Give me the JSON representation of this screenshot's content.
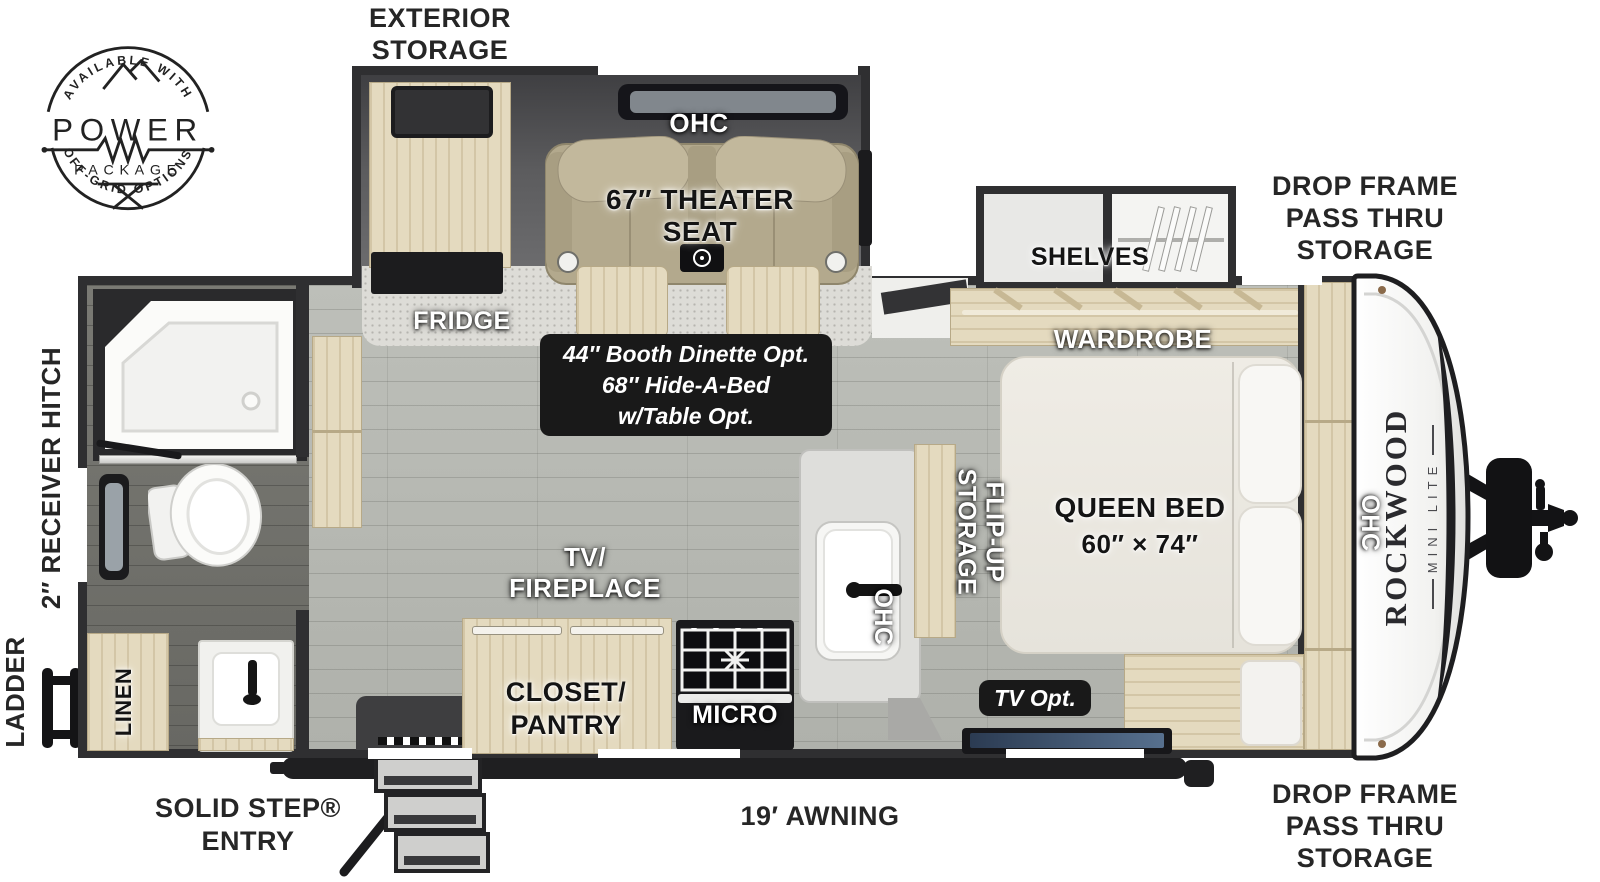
{
  "logo": {
    "arc_top": "AVAILABLE WITH",
    "word": "POWER",
    "word_sub": "PACKAGE",
    "arc_bottom": "OFF-GRID OPTIONS"
  },
  "labels": {
    "exterior_storage": [
      "EXTERIOR",
      "STORAGE"
    ],
    "drop_frame_top": [
      "DROP FRAME",
      "PASS THRU",
      "STORAGE"
    ],
    "drop_frame_bottom": [
      "DROP FRAME",
      "PASS THRU",
      "STORAGE"
    ],
    "receiver_hitch": "2″ RECEIVER HITCH",
    "ladder": "LADDER",
    "solid_step": [
      "SOLID STEP®",
      "ENTRY"
    ],
    "awning": "19′ AWNING"
  },
  "rooms": {
    "ohc_slide": "OHC",
    "theater_seat": [
      "67″ THEATER",
      "SEAT"
    ],
    "fridge": "FRIDGE",
    "dinette_option": [
      "44″ Booth Dinette Opt.",
      "68″ Hide-A-Bed",
      "w/Table Opt."
    ],
    "shelves": "SHELVES",
    "wardrobe": "WARDROBE",
    "queen_bed": [
      "QUEEN BED",
      "60″ × 74″"
    ],
    "ohc_bed": "OHC",
    "flip_up_storage": [
      "FLIP-UP",
      "STORAGE"
    ],
    "tv_option": "TV Opt.",
    "tv_fireplace": [
      "TV/",
      "FIREPLACE"
    ],
    "closet_pantry": [
      "CLOSET/",
      "PANTRY"
    ],
    "micro": "MICRO",
    "ohc_kitchen": "OHC",
    "linen": "LINEN"
  },
  "brand": {
    "name": "ROCKWOOD",
    "model": "MINI LITE"
  }
}
